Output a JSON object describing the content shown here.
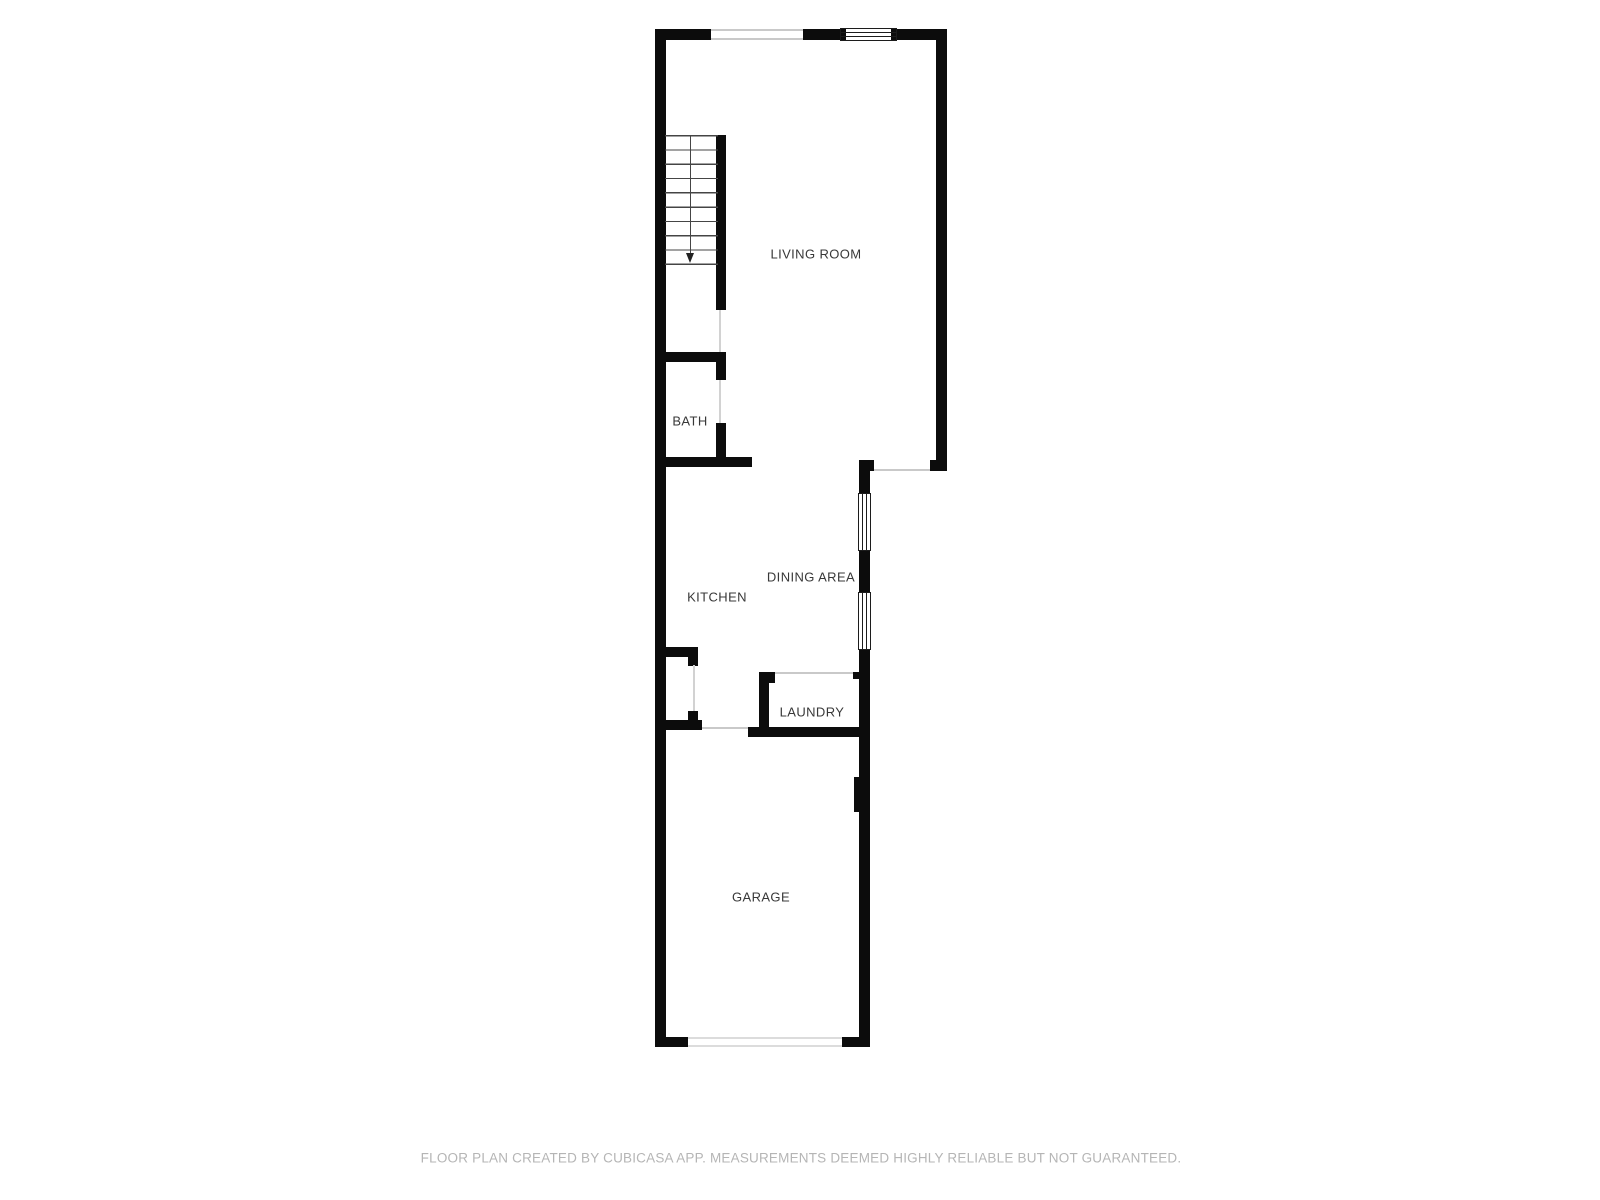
{
  "floorplan": {
    "rooms": {
      "living_room": {
        "label": "LIVING ROOM"
      },
      "bath": {
        "label": "BATH"
      },
      "kitchen": {
        "label": "KITCHEN"
      },
      "dining_area": {
        "label": "DINING AREA"
      },
      "laundry": {
        "label": "LAUNDRY"
      },
      "garage": {
        "label": "GARAGE"
      }
    },
    "stairs": {
      "direction": "down",
      "treads": 10
    },
    "colors": {
      "wall": "#0c0c0c",
      "window_frame": "#1c1c1c",
      "opening_line": "#c9c9c9",
      "door_line": "#d2d2d2",
      "garage_door_line": "#dcdcdc",
      "stair_line": "#454545",
      "room_label": "#383838",
      "footer_text": "#b5b5b5",
      "background": "#ffffff"
    }
  },
  "footer": {
    "disclaimer": "FLOOR PLAN CREATED BY CUBICASA APP. MEASUREMENTS DEEMED HIGHLY RELIABLE BUT NOT GUARANTEED."
  }
}
